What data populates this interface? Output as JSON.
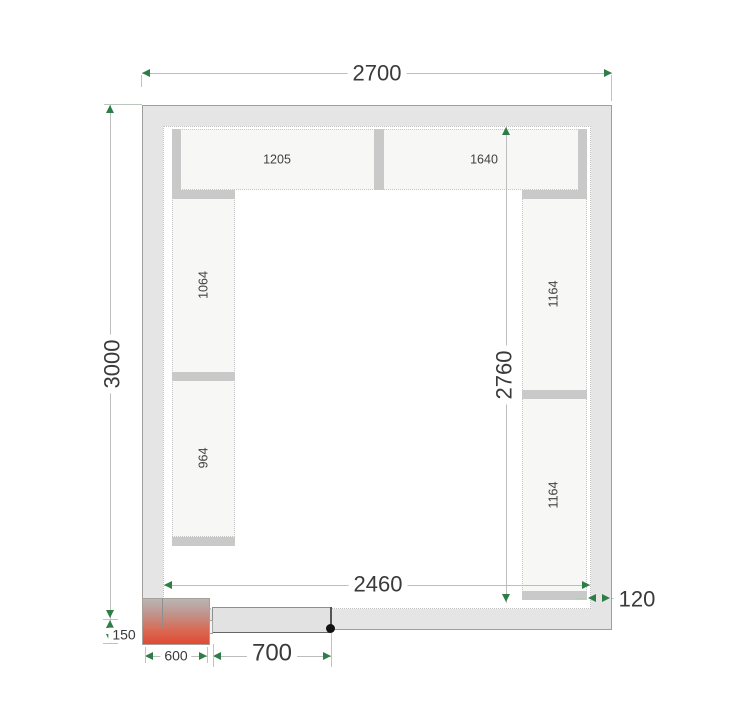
{
  "plan": {
    "type": "cold-room floor plan",
    "dimensions": {
      "outer_width": "2700",
      "outer_height": "3000",
      "inner_width": "2460",
      "inner_height": "2760",
      "wall_thickness": "120",
      "door_width": "700",
      "unit_width": "600",
      "unit_protrusion": "150"
    },
    "shelves": {
      "top_left": "1205",
      "top_right": "1640",
      "left_upper": "1064",
      "left_lower": "964",
      "right_upper": "1164",
      "right_lower": "1164"
    },
    "colors": {
      "dimension_arrow_green": "#2e7d46",
      "wall_fill": "#e5e5e5",
      "wall_outline": "#9e9e9e",
      "shelf_fill": "#f7f7f6",
      "divider_fill": "#c9c9c9",
      "unit_gradient_top": "#b7b6b5",
      "unit_gradient_bottom": "#e04a33",
      "text": "#3a3a3a"
    }
  }
}
